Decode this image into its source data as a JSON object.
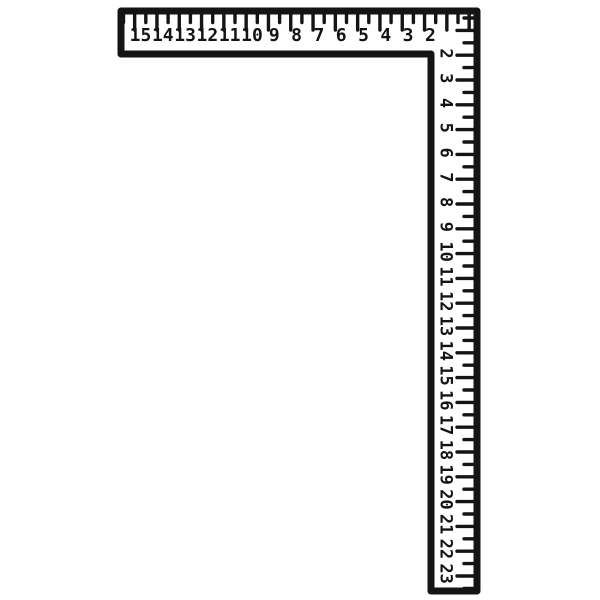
{
  "illustration": {
    "object": "Carpenter framing square (L-square) line drawing",
    "ink_color": "#141414",
    "paper_color": "#ffffff",
    "horizontal_scale": {
      "numbers": [
        "15",
        "14",
        "13",
        "12",
        "11",
        "10",
        "9",
        "8",
        "7",
        "6",
        "5",
        "4",
        "3",
        "2"
      ]
    },
    "vertical_scale": {
      "numbers": [
        "2",
        "3",
        "4",
        "5",
        "6",
        "7",
        "8",
        "9",
        "10",
        "11",
        "12",
        "13",
        "14",
        "15",
        "16",
        "17",
        "18",
        "19",
        "20",
        "21",
        "22",
        "23"
      ]
    }
  }
}
